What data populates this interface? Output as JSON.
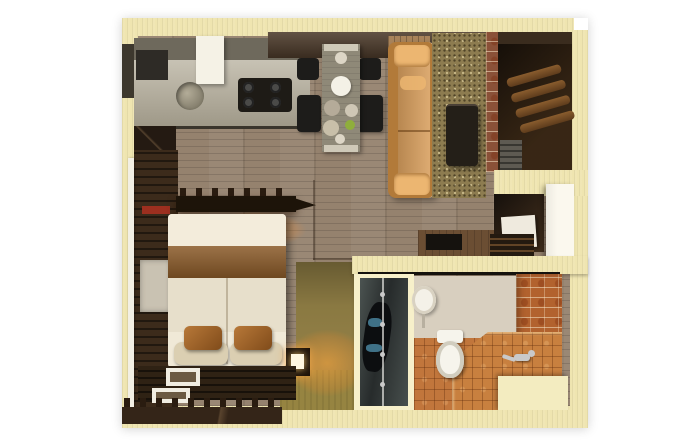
{
  "scene": {
    "type": "3d-floorplan-render",
    "description": "Photorealistic top-down 3D render of a studio apartment floor plan on a white background",
    "rooms": [
      {
        "name": "kitchen",
        "items": [
          "counter",
          "sink",
          "gas-stove",
          "range-hood",
          "refrigerator",
          "backsplash"
        ]
      },
      {
        "name": "dining",
        "items": [
          "dining-table",
          "four-black-chairs",
          "plates",
          "green-bowl"
        ]
      },
      {
        "name": "living",
        "items": [
          "orange-sofa",
          "speckled-area-rug",
          "dark-coffee-table",
          "brick-partition"
        ]
      },
      {
        "name": "entry-hall",
        "items": [
          "wood-slat-coat-rack",
          "shoe-cabinet",
          "white-entry-door",
          "storage-niche",
          "desk"
        ]
      },
      {
        "name": "bedroom",
        "items": [
          "double-bed",
          "rust-pillows",
          "cream-pillows",
          "nightstand-lamp",
          "peg-shelf",
          "wardrobe",
          "dark-slat-rug",
          "picture-frames",
          "crenellated-accent-wall",
          "window-track"
        ]
      },
      {
        "name": "bathroom",
        "items": [
          "glass-wardrobe",
          "toilet",
          "round-basin-mirror",
          "tiled-bench",
          "faucet",
          "terracotta-tile-floor",
          "brick-tile-wall",
          "step-block"
        ]
      }
    ],
    "palette": {
      "background": "#ffffff",
      "wall": "#efe5b0",
      "wallBright": "#f7f0ca",
      "floor": "#95826e",
      "oliveFloor": "#8a7942",
      "oliveFloorLight": "#968441",
      "rug": "#8d7c50",
      "sofa": "#d89f5e",
      "sofaBack": "#b27a39",
      "sofaArm": "#ecb671",
      "bulkhead": "#4c3a2a",
      "bulkheadWood": "#a8835a",
      "entryDark": "#261b10",
      "brickPartition": "#8a5138",
      "counter": "#b5ae9b",
      "backsplash": "#6e695c",
      "stove": "#1e1b16",
      "hood": "#f5f2e6",
      "tableTop": "#8f8978",
      "chair": "#1d1c1a",
      "coffeeTable": "#241f18",
      "marble": "#d8cfbf",
      "tile": "#c1763c",
      "tileBrick": "#b2622e",
      "benchTile": "#c8803f",
      "stepBlock": "#f3ecc0",
      "toilet": "#f6f4ec",
      "wardrobeDark": "#3c2b1b",
      "wardrobeGlass": "#1a1d1e",
      "bedWhite": "#f0e9d7",
      "bedLower": "#e7dfcb",
      "bedBand": "#8a5a28",
      "pillowRust": "#a05e20",
      "pillowCream": "#dbcfb2",
      "darkRug": "#2f2214",
      "crenelWall": "#342518",
      "doorWhite": "#fbf8ee",
      "nicheDark": "#30241a",
      "deskWood": "#6b4e33",
      "mirrorPanel": "#c9c2b2",
      "redShelfItem": "#9c2f1f",
      "clothesBlue": "#3f7187",
      "chrome": "#c9c9c9"
    }
  }
}
